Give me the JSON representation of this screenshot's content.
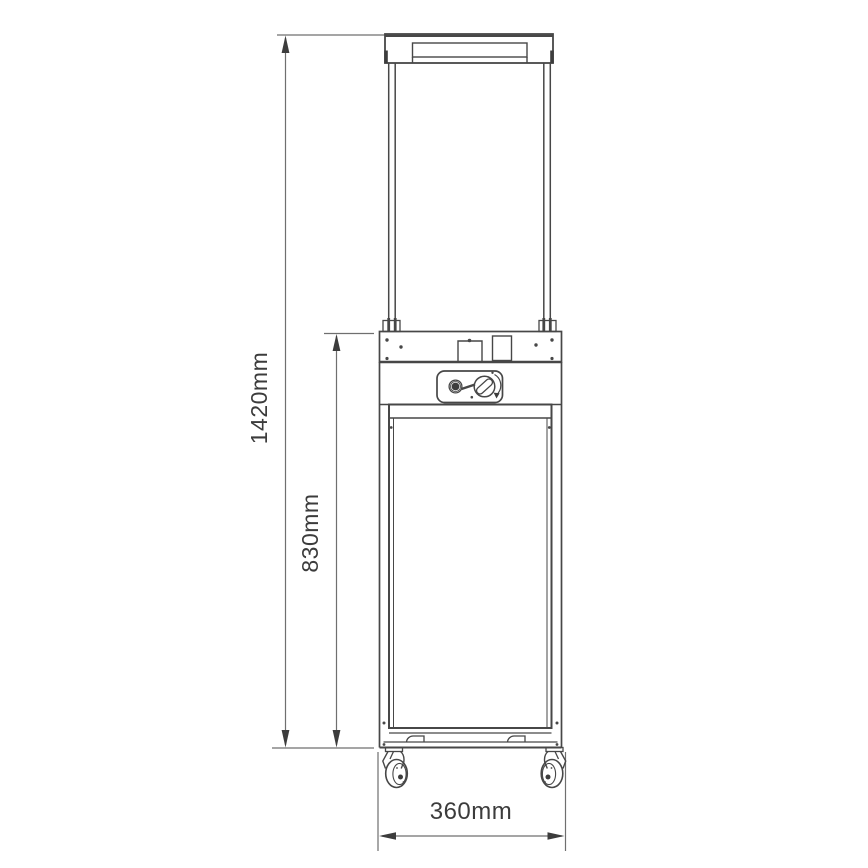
{
  "colors": {
    "background": "#ffffff",
    "line": "#474747",
    "dimension_line": "#6f6f6f",
    "text": "#3c3c3c"
  },
  "dimensions": {
    "overall_height": {
      "label": "1420mm"
    },
    "body_height": {
      "label": "830mm"
    },
    "width": {
      "label": "360mm"
    }
  }
}
